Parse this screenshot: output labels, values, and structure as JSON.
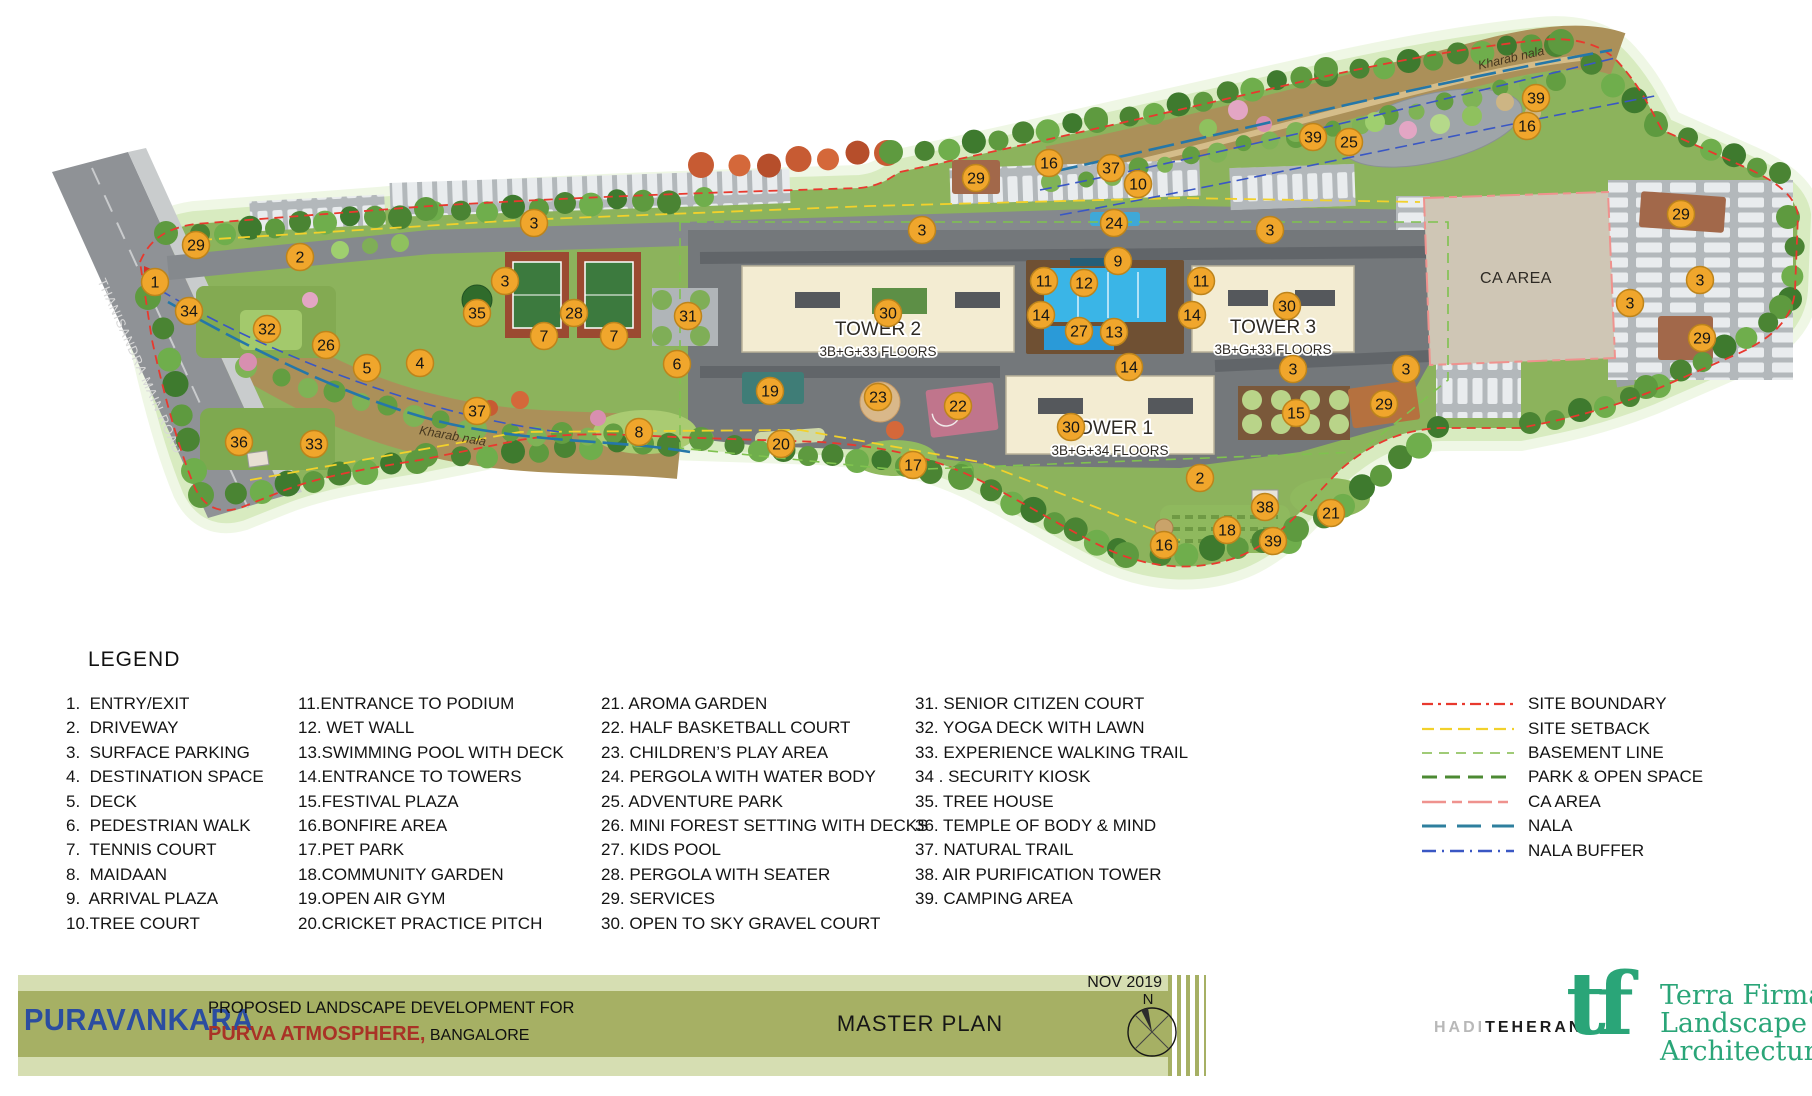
{
  "plan": {
    "road_label": "THANISANDRA MAIN ROAD",
    "ca_area_label": "CA AREA",
    "nala_labels": [
      {
        "text": "Kharab nala",
        "x": 452,
        "y": 440,
        "rot": 10
      },
      {
        "text": "Kharab nala",
        "x": 1512,
        "y": 62,
        "rot": -13
      }
    ],
    "towers": [
      {
        "name": "TOWER 2",
        "floors": "3B+G+33 FLOORS",
        "x": 878,
        "y": 335
      },
      {
        "name": "TOWER 3",
        "floors": "3B+G+33 FLOORS",
        "x": 1273,
        "y": 333
      },
      {
        "name": "TOWER 1",
        "floors": "3B+G+34 FLOORS",
        "x": 1110,
        "y": 434
      }
    ],
    "marker_fill": "#F0A62C",
    "marker_stroke": "#BD841B",
    "markers": [
      {
        "n": "29",
        "x": 196,
        "y": 245
      },
      {
        "n": "2",
        "x": 300,
        "y": 257
      },
      {
        "n": "1",
        "x": 155,
        "y": 282
      },
      {
        "n": "34",
        "x": 189,
        "y": 311
      },
      {
        "n": "32",
        "x": 267,
        "y": 329
      },
      {
        "n": "26",
        "x": 326,
        "y": 345
      },
      {
        "n": "5",
        "x": 367,
        "y": 368
      },
      {
        "n": "4",
        "x": 420,
        "y": 363
      },
      {
        "n": "36",
        "x": 239,
        "y": 442
      },
      {
        "n": "33",
        "x": 314,
        "y": 444
      },
      {
        "n": "37",
        "x": 477,
        "y": 411
      },
      {
        "n": "3",
        "x": 534,
        "y": 223
      },
      {
        "n": "3",
        "x": 505,
        "y": 281
      },
      {
        "n": "35",
        "x": 477,
        "y": 313
      },
      {
        "n": "28",
        "x": 574,
        "y": 313
      },
      {
        "n": "7",
        "x": 544,
        "y": 336
      },
      {
        "n": "7",
        "x": 614,
        "y": 336
      },
      {
        "n": "31",
        "x": 688,
        "y": 316
      },
      {
        "n": "6",
        "x": 677,
        "y": 364
      },
      {
        "n": "8",
        "x": 639,
        "y": 432
      },
      {
        "n": "19",
        "x": 770,
        "y": 391
      },
      {
        "n": "20",
        "x": 781,
        "y": 444
      },
      {
        "n": "23",
        "x": 878,
        "y": 397
      },
      {
        "n": "17",
        "x": 913,
        "y": 465
      },
      {
        "n": "22",
        "x": 958,
        "y": 406
      },
      {
        "n": "29",
        "x": 976,
        "y": 178
      },
      {
        "n": "16",
        "x": 1049,
        "y": 163
      },
      {
        "n": "37",
        "x": 1111,
        "y": 168
      },
      {
        "n": "10",
        "x": 1138,
        "y": 184
      },
      {
        "n": "24",
        "x": 1114,
        "y": 223
      },
      {
        "n": "3",
        "x": 922,
        "y": 230
      },
      {
        "n": "9",
        "x": 1118,
        "y": 261
      },
      {
        "n": "11",
        "x": 1044,
        "y": 281
      },
      {
        "n": "12",
        "x": 1084,
        "y": 283
      },
      {
        "n": "11",
        "x": 1201,
        "y": 281
      },
      {
        "n": "14",
        "x": 1041,
        "y": 315
      },
      {
        "n": "27",
        "x": 1079,
        "y": 331
      },
      {
        "n": "13",
        "x": 1114,
        "y": 332
      },
      {
        "n": "14",
        "x": 1192,
        "y": 315
      },
      {
        "n": "30",
        "x": 888,
        "y": 313
      },
      {
        "n": "30",
        "x": 1287,
        "y": 306
      },
      {
        "n": "3",
        "x": 1270,
        "y": 230
      },
      {
        "n": "14",
        "x": 1129,
        "y": 367
      },
      {
        "n": "30",
        "x": 1071,
        "y": 427
      },
      {
        "n": "15",
        "x": 1296,
        "y": 413
      },
      {
        "n": "2",
        "x": 1200,
        "y": 478
      },
      {
        "n": "38",
        "x": 1265,
        "y": 507
      },
      {
        "n": "21",
        "x": 1331,
        "y": 513
      },
      {
        "n": "18",
        "x": 1227,
        "y": 530
      },
      {
        "n": "39",
        "x": 1273,
        "y": 541
      },
      {
        "n": "16",
        "x": 1164,
        "y": 545
      },
      {
        "n": "39",
        "x": 1313,
        "y": 137
      },
      {
        "n": "25",
        "x": 1349,
        "y": 142
      },
      {
        "n": "39",
        "x": 1536,
        "y": 98
      },
      {
        "n": "16",
        "x": 1527,
        "y": 126
      },
      {
        "n": "29",
        "x": 1681,
        "y": 214
      },
      {
        "n": "3",
        "x": 1700,
        "y": 280
      },
      {
        "n": "3",
        "x": 1630,
        "y": 303
      },
      {
        "n": "29",
        "x": 1702,
        "y": 338
      },
      {
        "n": "3",
        "x": 1293,
        "y": 369
      },
      {
        "n": "3",
        "x": 1406,
        "y": 369
      },
      {
        "n": "29",
        "x": 1384,
        "y": 404
      }
    ]
  },
  "legend": {
    "title": "LEGEND",
    "columns": [
      [
        "1.  ENTRY/EXIT",
        "2.  DRIVEWAY",
        "3.  SURFACE PARKING",
        "4.  DESTINATION SPACE",
        "5.  DECK",
        "6.  PEDESTRIAN WALK",
        "7.  TENNIS COURT",
        "8.  MAIDAAN",
        "9.  ARRIVAL PLAZA",
        "10.TREE COURT"
      ],
      [
        "11.ENTRANCE TO PODIUM",
        "12. WET WALL",
        "13.SWIMMING POOL WITH DECK",
        "14.ENTRANCE TO TOWERS",
        "15.FESTIVAL PLAZA",
        "16.BONFIRE AREA",
        "17.PET PARK",
        "18.COMMUNITY GARDEN",
        "19.OPEN AIR GYM",
        "20.CRICKET PRACTICE PITCH"
      ],
      [
        "21. AROMA GARDEN",
        "22. HALF BASKETBALL COURT",
        "23. CHILDREN’S PLAY AREA",
        "24. PERGOLA WITH WATER BODY",
        "25. ADVENTURE PARK",
        "26. MINI FOREST SETTING WITH DECKS",
        "27. KIDS POOL",
        "28. PERGOLA WITH SEATER",
        "29. SERVICES",
        "30. OPEN TO SKY GRAVEL COURT"
      ],
      [
        "31. SENIOR CITIZEN COURT",
        "32. YOGA DECK WITH LAWN",
        "33. EXPERIENCE WALKING TRAIL",
        "34 . SECURITY KIOSK",
        "35. TREE HOUSE",
        "36. TEMPLE OF BODY & MIND",
        "37. NATURAL TRAIL",
        "38. AIR PURIFICATION TOWER",
        "39. CAMPING AREA"
      ]
    ],
    "lines": [
      {
        "label": "SITE BOUNDARY",
        "color": "#E8392E",
        "dash": "11 5 3 5",
        "width": 2.2
      },
      {
        "label": "SITE SETBACK",
        "color": "#F2D12B",
        "dash": "12 6",
        "width": 2.2
      },
      {
        "label": "BASEMENT LINE",
        "color": "#93C464",
        "dash": "10 7",
        "width": 1.8
      },
      {
        "label": "PARK & OPEN SPACE",
        "color": "#4C8A33",
        "dash": "15 8",
        "width": 3
      },
      {
        "label": "CA AREA",
        "color": "#EF928E",
        "dash": "24 6 10 6",
        "width": 2.4
      },
      {
        "label": "NALA",
        "color": "#2E7F9E",
        "dash": "24 11",
        "width": 3
      },
      {
        "label": "NALA BUFFER",
        "color": "#3A57C4",
        "dash": "14 6 2 6",
        "width": 2.4
      }
    ]
  },
  "footer": {
    "brand": "PURAVΛNKARA",
    "line1": "PROPOSED LANDSCAPE DEVELOPMENT FOR",
    "project": "PURVA ATMOSPHERE,",
    "city": " BANGALORE",
    "center_title": "MASTER PLAN",
    "date": "NOV 2019",
    "north": "N",
    "architect_light": "HADI",
    "architect_bold": "TEHERANI",
    "tf_logo": "tf",
    "studio_lines": [
      "Terra Firma",
      "Landscape",
      "Architecture"
    ],
    "colors": {
      "olive": "#A6B064",
      "light_green": "#D6DEB2",
      "brand_blue": "#2B4DA0",
      "project_red": "#A93226",
      "tf_green": "#2AA578"
    }
  }
}
